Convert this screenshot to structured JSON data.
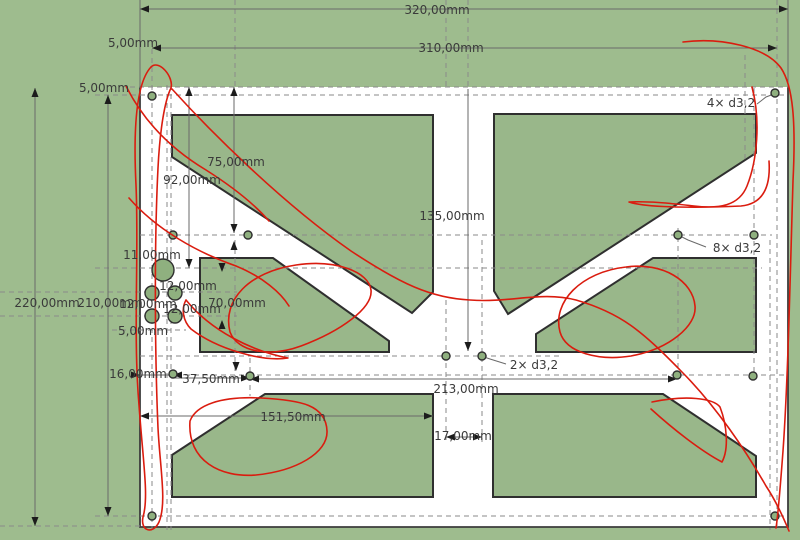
{
  "view": {
    "type": "cad-drawing-viewport",
    "part": "plate-with-x-brace-cutouts"
  },
  "colors": {
    "background": "#9ebc8e",
    "plate": "#ffffff",
    "cutout_fill": "#93b285",
    "outline": "#2f2f2f",
    "construction": "#8a8a8a",
    "dimension_line": "#6a6a6a",
    "dimension_text": "#3a3a3a",
    "sketch": "#da1c0f",
    "arrow": "#1c1c1c"
  },
  "labels": [
    {
      "t": "320,00mm",
      "x": 437,
      "y": 14,
      "n": "dim-320"
    },
    {
      "t": "310,00mm",
      "x": 451,
      "y": 52,
      "n": "dim-310"
    },
    {
      "t": "5,00mm",
      "x": 133,
      "y": 47,
      "n": "dim-5-top"
    },
    {
      "t": "5,00mm",
      "x": 104,
      "y": 92,
      "n": "dim-5-left"
    },
    {
      "t": "75,00mm",
      "x": 236,
      "y": 166,
      "n": "dim-75"
    },
    {
      "t": "92,00mm",
      "x": 192,
      "y": 184,
      "n": "dim-92"
    },
    {
      "t": "135,00mm",
      "x": 452,
      "y": 220,
      "n": "dim-135"
    },
    {
      "t": "11,00mm",
      "x": 152,
      "y": 259,
      "n": "dim-11"
    },
    {
      "t": "12,00mm",
      "x": 188,
      "y": 290,
      "n": "dim-12-a"
    },
    {
      "t": "12,00mm",
      "x": 148,
      "y": 308,
      "n": "dim-12-b"
    },
    {
      "t": "12,00mm",
      "x": 192,
      "y": 313,
      "n": "dim-12-c"
    },
    {
      "t": "70,00mm",
      "x": 237,
      "y": 307,
      "n": "dim-70"
    },
    {
      "t": "220,00mm",
      "x": 47,
      "y": 307,
      "n": "dim-220"
    },
    {
      "t": "210,00mm",
      "x": 110,
      "y": 307,
      "n": "dim-210"
    },
    {
      "t": "5,00mm",
      "x": 143,
      "y": 335,
      "n": "dim-5-cluster"
    },
    {
      "t": "16,00mm",
      "x": 138,
      "y": 378,
      "n": "dim-16"
    },
    {
      "t": "37,50mm",
      "x": 211,
      "y": 383,
      "n": "dim-37-5"
    },
    {
      "t": "151,50mm",
      "x": 293,
      "y": 421,
      "n": "dim-151-5"
    },
    {
      "t": "213,00mm",
      "x": 466,
      "y": 393,
      "n": "dim-213"
    },
    {
      "t": "17,00mm",
      "x": 463,
      "y": 440,
      "n": "dim-17"
    },
    {
      "t": "2× d3,2",
      "x": 534,
      "y": 369,
      "n": "note-2x-d32"
    },
    {
      "t": "8× d3,2",
      "x": 737,
      "y": 252,
      "n": "note-8x-d32"
    },
    {
      "t": "4× d3,2",
      "x": 731,
      "y": 107,
      "n": "note-4x-d32"
    }
  ],
  "holes": {
    "d32_corner": {
      "r": 4,
      "pts": [
        [
          152,
          96
        ],
        [
          775,
          93
        ],
        [
          152,
          516
        ],
        [
          775,
          516
        ]
      ]
    },
    "d32_mid": {
      "r": 4,
      "pts": [
        [
          173,
          235
        ],
        [
          248,
          235
        ],
        [
          678,
          235
        ],
        [
          754,
          235
        ],
        [
          173,
          374
        ],
        [
          250,
          376
        ],
        [
          677,
          375
        ],
        [
          753,
          376
        ]
      ]
    },
    "d32_center": {
      "r": 4,
      "pts": [
        [
          446,
          356
        ],
        [
          482,
          356
        ]
      ]
    },
    "cluster_medium": {
      "r": 7,
      "pts": [
        [
          152,
          293
        ],
        [
          175,
          293
        ],
        [
          152,
          316
        ],
        [
          175,
          316
        ]
      ]
    },
    "cluster_large": {
      "r": 11,
      "pts": [
        [
          163,
          270
        ]
      ]
    }
  }
}
